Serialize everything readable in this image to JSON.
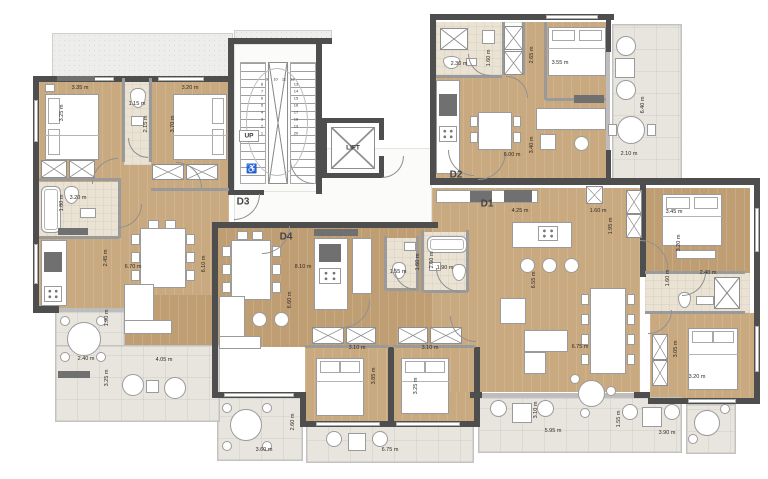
{
  "title": "Residential building floor plan",
  "colors": {
    "wall": "#4e4e4e",
    "wood_floor": "#c9aa80",
    "tile_floor": "#eae2d3",
    "balcony_floor": "#e8e5de",
    "terrace_floor": "#ededeb",
    "furniture": "#ffffff",
    "dark_fixture": "#707070",
    "dimension_text": "#2e2a24"
  },
  "labels": {
    "up": "UP",
    "lift": "LIFT"
  },
  "icons": {
    "accessible": "♿"
  },
  "apartment_labels": [
    {
      "text": "D3",
      "x": 243,
      "y": 202
    },
    {
      "text": "D4",
      "x": 286,
      "y": 237
    },
    {
      "text": "D2",
      "x": 456,
      "y": 175
    },
    {
      "text": "D1",
      "x": 487,
      "y": 204
    }
  ],
  "stairs": {
    "left_col": [
      "8",
      "7",
      "6",
      "5",
      "4",
      "3",
      "2",
      "1"
    ],
    "top_row": [
      "9",
      "10",
      "11",
      "12"
    ],
    "right_col": [
      "13",
      "14",
      "15",
      "16",
      "17",
      "18",
      "19",
      "20"
    ]
  },
  "dimensions": [
    {
      "t": "3.35 m",
      "x": 80,
      "y": 88
    },
    {
      "t": "3.25 m",
      "x": 62,
      "y": 113,
      "v": 1
    },
    {
      "t": "1.15 m",
      "x": 137,
      "y": 104
    },
    {
      "t": "2.15 m",
      "x": 146,
      "y": 124,
      "v": 1
    },
    {
      "t": "3.20 m",
      "x": 190,
      "y": 88
    },
    {
      "t": "3.70 m",
      "x": 173,
      "y": 124,
      "v": 1
    },
    {
      "t": "3.20 m",
      "x": 78,
      "y": 198
    },
    {
      "t": "1.80 m",
      "x": 62,
      "y": 203,
      "v": 1
    },
    {
      "t": "2.45 m",
      "x": 106,
      "y": 258,
      "v": 1
    },
    {
      "t": "6.70 m",
      "x": 133,
      "y": 267
    },
    {
      "t": "1.90 m",
      "x": 107,
      "y": 318,
      "v": 1
    },
    {
      "t": "2.40 m",
      "x": 86,
      "y": 359
    },
    {
      "t": "4.05 m",
      "x": 164,
      "y": 360
    },
    {
      "t": "3.25 m",
      "x": 107,
      "y": 378,
      "v": 1
    },
    {
      "t": "6.10 m",
      "x": 204,
      "y": 264,
      "v": 1
    },
    {
      "t": "8.10 m",
      "x": 303,
      "y": 267
    },
    {
      "t": "6.60 m",
      "x": 290,
      "y": 300,
      "v": 1
    },
    {
      "t": "1.55 m",
      "x": 398,
      "y": 272
    },
    {
      "t": "1.60 m",
      "x": 418,
      "y": 262,
      "v": 1
    },
    {
      "t": "1.90 m",
      "x": 445,
      "y": 268
    },
    {
      "t": "2.60 m",
      "x": 432,
      "y": 260,
      "v": 1
    },
    {
      "t": "3.10 m",
      "x": 357,
      "y": 348
    },
    {
      "t": "3.10 m",
      "x": 430,
      "y": 348
    },
    {
      "t": "3.85 m",
      "x": 374,
      "y": 376,
      "v": 1
    },
    {
      "t": "3.25 m",
      "x": 416,
      "y": 386,
      "v": 1
    },
    {
      "t": "3.60 m",
      "x": 264,
      "y": 450
    },
    {
      "t": "2.60 m",
      "x": 293,
      "y": 422,
      "v": 1
    },
    {
      "t": "6.75 m",
      "x": 390,
      "y": 450
    },
    {
      "t": "2.30 m",
      "x": 459,
      "y": 64
    },
    {
      "t": "1.60 m",
      "x": 489,
      "y": 58,
      "v": 1
    },
    {
      "t": "2.65 m",
      "x": 532,
      "y": 55,
      "v": 1
    },
    {
      "t": "3.55 m",
      "x": 560,
      "y": 63
    },
    {
      "t": "6.00 m",
      "x": 512,
      "y": 155
    },
    {
      "t": "3.40 m",
      "x": 532,
      "y": 145,
      "v": 1
    },
    {
      "t": "6.40 m",
      "x": 643,
      "y": 105,
      "v": 1
    },
    {
      "t": "2.10 m",
      "x": 629,
      "y": 154
    },
    {
      "t": "4.25 m",
      "x": 520,
      "y": 211
    },
    {
      "t": "1.60 m",
      "x": 598,
      "y": 211
    },
    {
      "t": "1.95 m",
      "x": 611,
      "y": 226,
      "v": 1
    },
    {
      "t": "3.45 m",
      "x": 674,
      "y": 212
    },
    {
      "t": "3.20 m",
      "x": 679,
      "y": 243,
      "v": 1
    },
    {
      "t": "2.40 m",
      "x": 708,
      "y": 273
    },
    {
      "t": "1.60 m",
      "x": 668,
      "y": 278,
      "v": 1
    },
    {
      "t": "6.55 m",
      "x": 534,
      "y": 280,
      "v": 1
    },
    {
      "t": "6.75 m",
      "x": 580,
      "y": 347
    },
    {
      "t": "3.20 m",
      "x": 697,
      "y": 377
    },
    {
      "t": "3.05 m",
      "x": 676,
      "y": 349,
      "v": 1
    },
    {
      "t": "5.95 m",
      "x": 553,
      "y": 431
    },
    {
      "t": "3.10 m",
      "x": 536,
      "y": 410,
      "v": 1
    },
    {
      "t": "1.55 m",
      "x": 619,
      "y": 419,
      "v": 1
    },
    {
      "t": "3.90 m",
      "x": 667,
      "y": 433
    }
  ]
}
